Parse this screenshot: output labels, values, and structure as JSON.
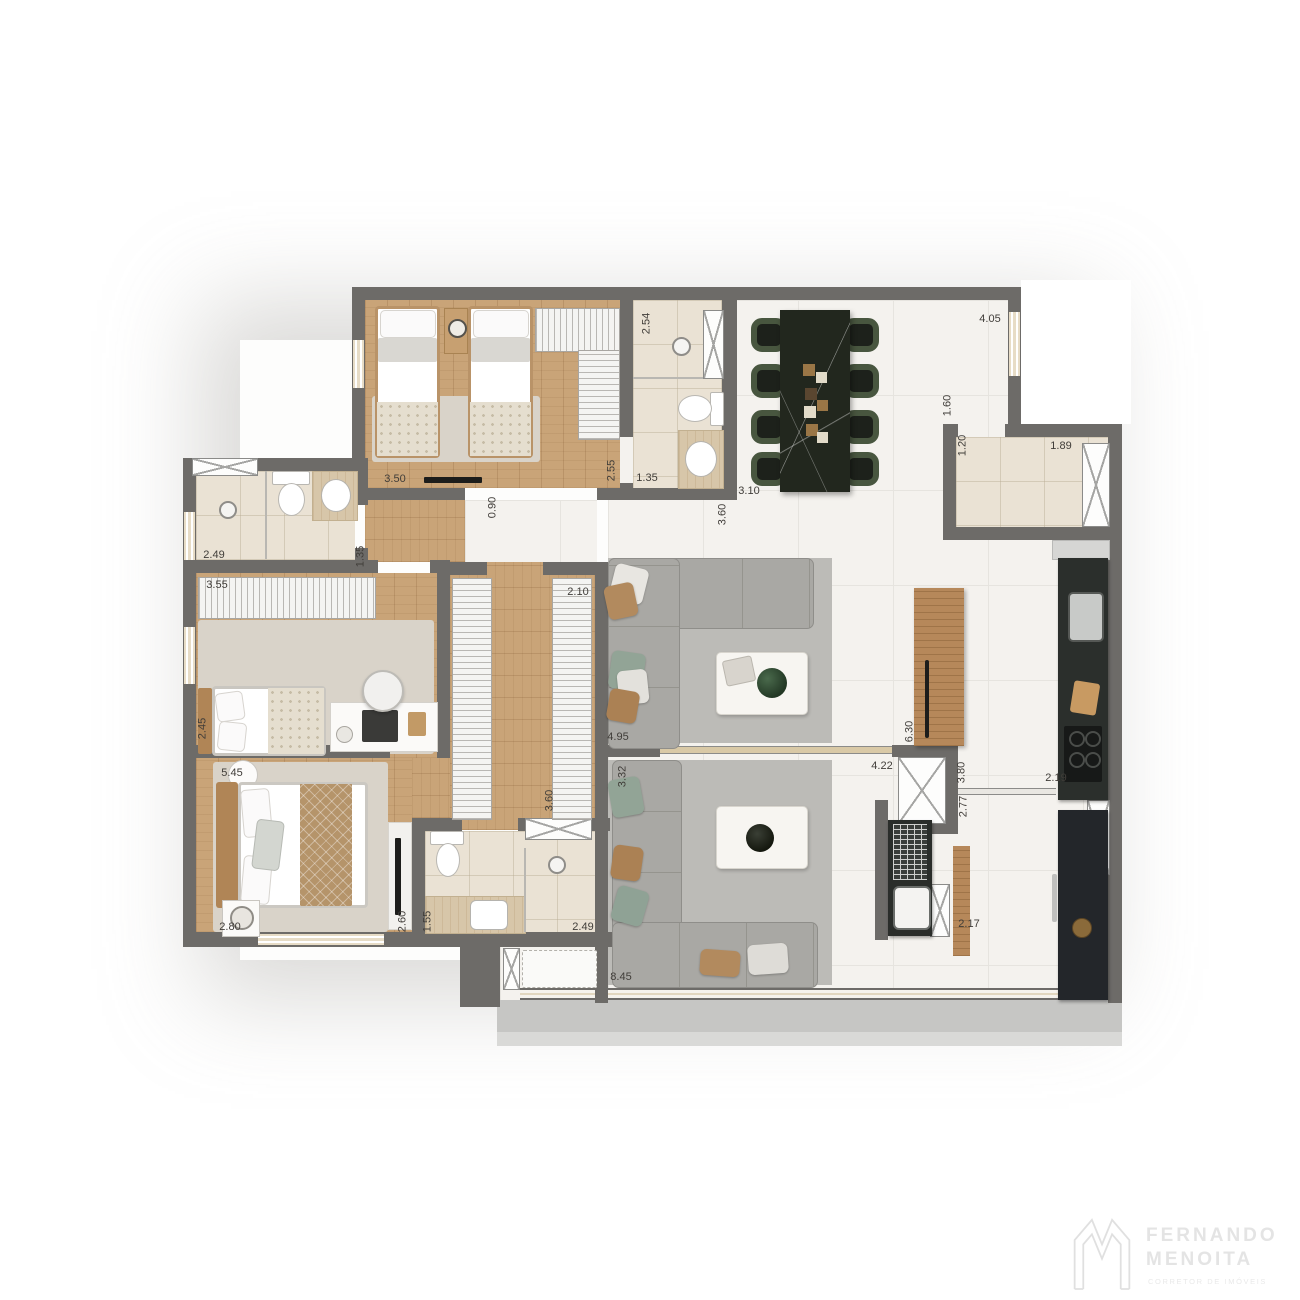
{
  "brand": {
    "line1": "FERNANDO",
    "line2": "MENOITA",
    "tagline": "CORRETOR DE IMÓVEIS"
  },
  "dims": {
    "twin_width": "3.50",
    "twin_depth": "2.55",
    "bath1_depth": "2.54",
    "bath1_width": "1.35",
    "hall_width": "0.90",
    "dining_width": "3.10",
    "dining_depth": "3.60",
    "terrace_window": "4.05",
    "living_side": "1.60",
    "powder_depth": "1.20",
    "powder_width": "1.89",
    "bath2_width": "2.49",
    "bath2_depth": "1.35",
    "closet2_width": "3.55",
    "bedroom2_depth": "2.45",
    "walkin_width": "2.10",
    "walkin_depth": "3.60",
    "living1_width": "4.95",
    "living2_depth": "3.32",
    "master_length": "5.45",
    "master_width": "2.80",
    "master_side": "2.60",
    "bath3_width": "1.55",
    "bath3_depth": "2.49",
    "balcony_width": "8.45",
    "kitchen_width": "4.22",
    "kitchen_island": "6.30",
    "kitchen_depth": "3.80",
    "service_depth": "2.77",
    "kitchen_counter": "2.19",
    "service_width": "2.17"
  },
  "colors": {
    "wall": "#6d6b68",
    "wood_floor": "#c9a478",
    "bath_tile": "#eae2d4",
    "marble_floor": "#f4f2ee",
    "sofa_gray": "#a9a8a4",
    "dining_chair_green": "#48563f",
    "dining_table_black": "#22271e",
    "balcony_slab": "#c6c6c4"
  }
}
